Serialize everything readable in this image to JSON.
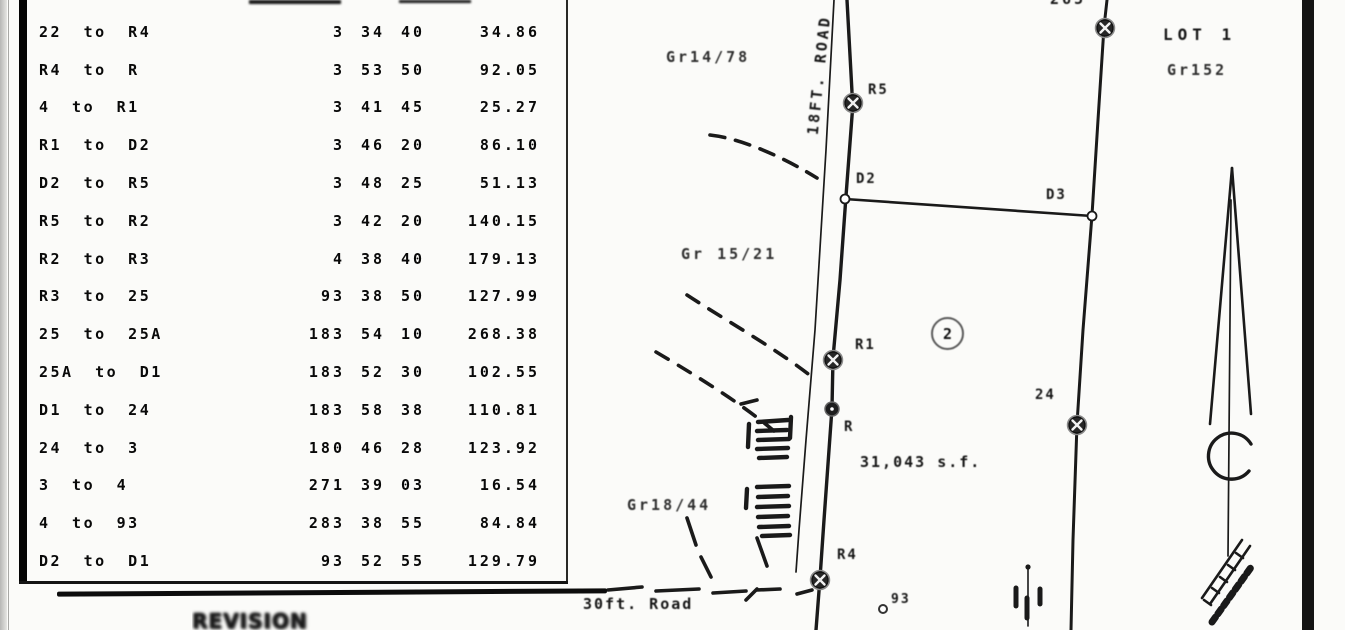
{
  "table": {
    "rows": [
      {
        "course": "22 to R4",
        "deg": "3",
        "min": "34",
        "sec": "40",
        "dist": "34.86"
      },
      {
        "course": "R4 to R",
        "deg": "3",
        "min": "53",
        "sec": "50",
        "dist": "92.05"
      },
      {
        "course": "4 to R1",
        "deg": "3",
        "min": "41",
        "sec": "45",
        "dist": "25.27"
      },
      {
        "course": "R1 to D2",
        "deg": "3",
        "min": "46",
        "sec": "20",
        "dist": "86.10"
      },
      {
        "course": "D2 to R5",
        "deg": "3",
        "min": "48",
        "sec": "25",
        "dist": "51.13"
      },
      {
        "course": "R5 to R2",
        "deg": "3",
        "min": "42",
        "sec": "20",
        "dist": "140.15"
      },
      {
        "course": "R2 to R3",
        "deg": "4",
        "min": "38",
        "sec": "40",
        "dist": "179.13"
      },
      {
        "course": "R3 to 25",
        "deg": "93",
        "min": "38",
        "sec": "50",
        "dist": "127.99"
      },
      {
        "course": "25 to 25A",
        "deg": "183",
        "min": "54",
        "sec": "10",
        "dist": "268.38"
      },
      {
        "course": "25A to D1",
        "deg": "183",
        "min": "52",
        "sec": "30",
        "dist": "102.55"
      },
      {
        "course": "D1 to 24",
        "deg": "183",
        "min": "58",
        "sec": "38",
        "dist": "110.81"
      },
      {
        "course": "24 to 3",
        "deg": "180",
        "min": "46",
        "sec": "28",
        "dist": "123.92"
      },
      {
        "course": "3 to 4",
        "deg": "271",
        "min": "39",
        "sec": "03",
        "dist": "16.54"
      },
      {
        "course": "4 to 93",
        "deg": "283",
        "min": "38",
        "sec": "55",
        "dist": "84.84"
      },
      {
        "course": "D2 to D1",
        "deg": "93",
        "min": "52",
        "sec": "55",
        "dist": "129.79"
      }
    ]
  },
  "stamp": {
    "text": "REVISION"
  },
  "map": {
    "road_label": "18FT. ROAD",
    "bottom_road_label": "30ft. Road",
    "labels": {
      "gr_upper": "Gr14/78",
      "gr_mid": "Gr 15/21",
      "gr_lower": "Gr18/44",
      "lot1": "LOT 1",
      "lot1_grant": "Gr152",
      "lot2_number": "2",
      "area": "31,043 s.f.",
      "pt_r5": "R5",
      "pt_d2": "D2",
      "pt_d3": "D3",
      "pt_r1": "R1",
      "pt_r": "R",
      "pt_24": "24",
      "pt_r4": "R4",
      "pt_93": "93",
      "top_cut": "265"
    }
  },
  "colors": {
    "ink": "#161616",
    "page_edge_bar": "#141414"
  }
}
